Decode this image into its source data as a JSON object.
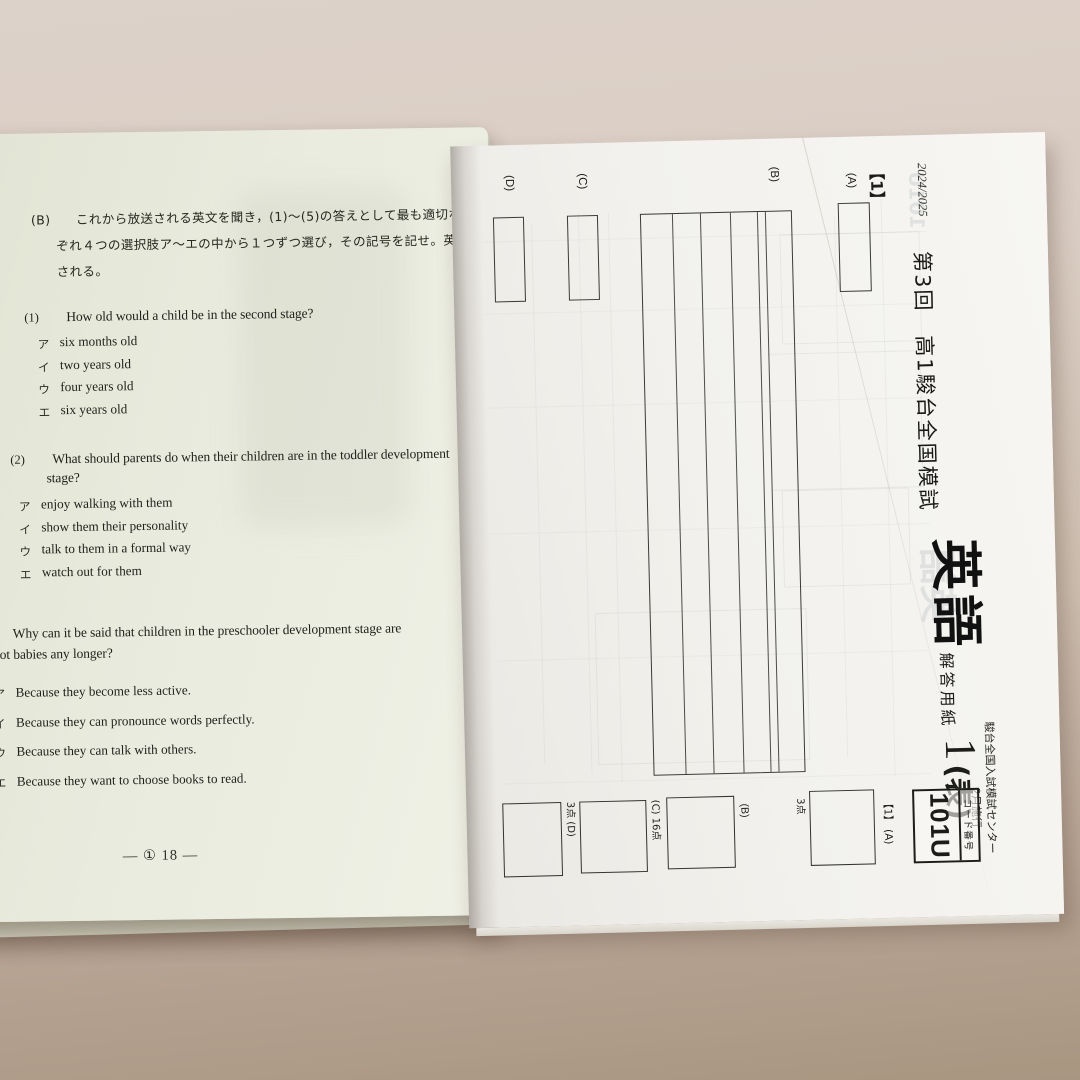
{
  "question_sheet": {
    "instruction": {
      "label": "(B)",
      "line1": "これから放送される英文を聞き，(1)～(5)の答えとして最も適切なものを，それ",
      "line2": "ぞれ４つの選択肢ア～エの中から１つずつ選び，その記号を記せ。英文は２度放送",
      "line3": "される。"
    },
    "questions": [
      {
        "number": "(1)",
        "text_line1": "How old would a child be in the second stage?",
        "text_line2": "",
        "choices": [
          {
            "letter": "ア",
            "text": "six months old"
          },
          {
            "letter": "イ",
            "text": "two years old"
          },
          {
            "letter": "ウ",
            "text": "four years old"
          },
          {
            "letter": "エ",
            "text": "six years old"
          }
        ]
      },
      {
        "number": "(2)",
        "text_line1": "What should parents do when their children are in the toddler development",
        "text_line2": "stage?",
        "choices": [
          {
            "letter": "ア",
            "text": "enjoy walking with them"
          },
          {
            "letter": "イ",
            "text": "show them their personality"
          },
          {
            "letter": "ウ",
            "text": "talk to them in a formal way"
          },
          {
            "letter": "エ",
            "text": "watch out for them"
          }
        ]
      },
      {
        "number": "(3)",
        "text_line1": "Why can it be said that children in the preschooler development stage are",
        "text_line2": "not babies any longer?",
        "choices": [
          {
            "letter": "ア",
            "text": "Because they become less active."
          },
          {
            "letter": "イ",
            "text": "Because they can pronounce words perfectly."
          },
          {
            "letter": "ウ",
            "text": "Because they can talk with others."
          },
          {
            "letter": "エ",
            "text": "Because they want to choose books to read."
          }
        ]
      }
    ],
    "page_footer": "— ① 18 —"
  },
  "answer_sheet": {
    "school_year": "2024/2025",
    "exam_title": "第3回　高1駿台全国模試",
    "subject": "英語",
    "sheet_type": "解答用紙",
    "sheet_number": "1",
    "sheet_side": "(表)",
    "organization": "駿台全国入試模試センター",
    "administered": "2月施行",
    "code_label": "コード番号",
    "code_value": "101U",
    "section_label": "【1】",
    "part_a_label": "(A)",
    "part_b_label": "(B)",
    "part_c_label": "(C)",
    "part_d_label": "(D)",
    "score_area": {
      "section_label": "【1】",
      "a_label": "(A)",
      "a_points": "3点",
      "b_label": "(B)",
      "c_label": "(C)",
      "c_points": "16点",
      "d_label": "(D)",
      "d_points": "3点"
    }
  }
}
